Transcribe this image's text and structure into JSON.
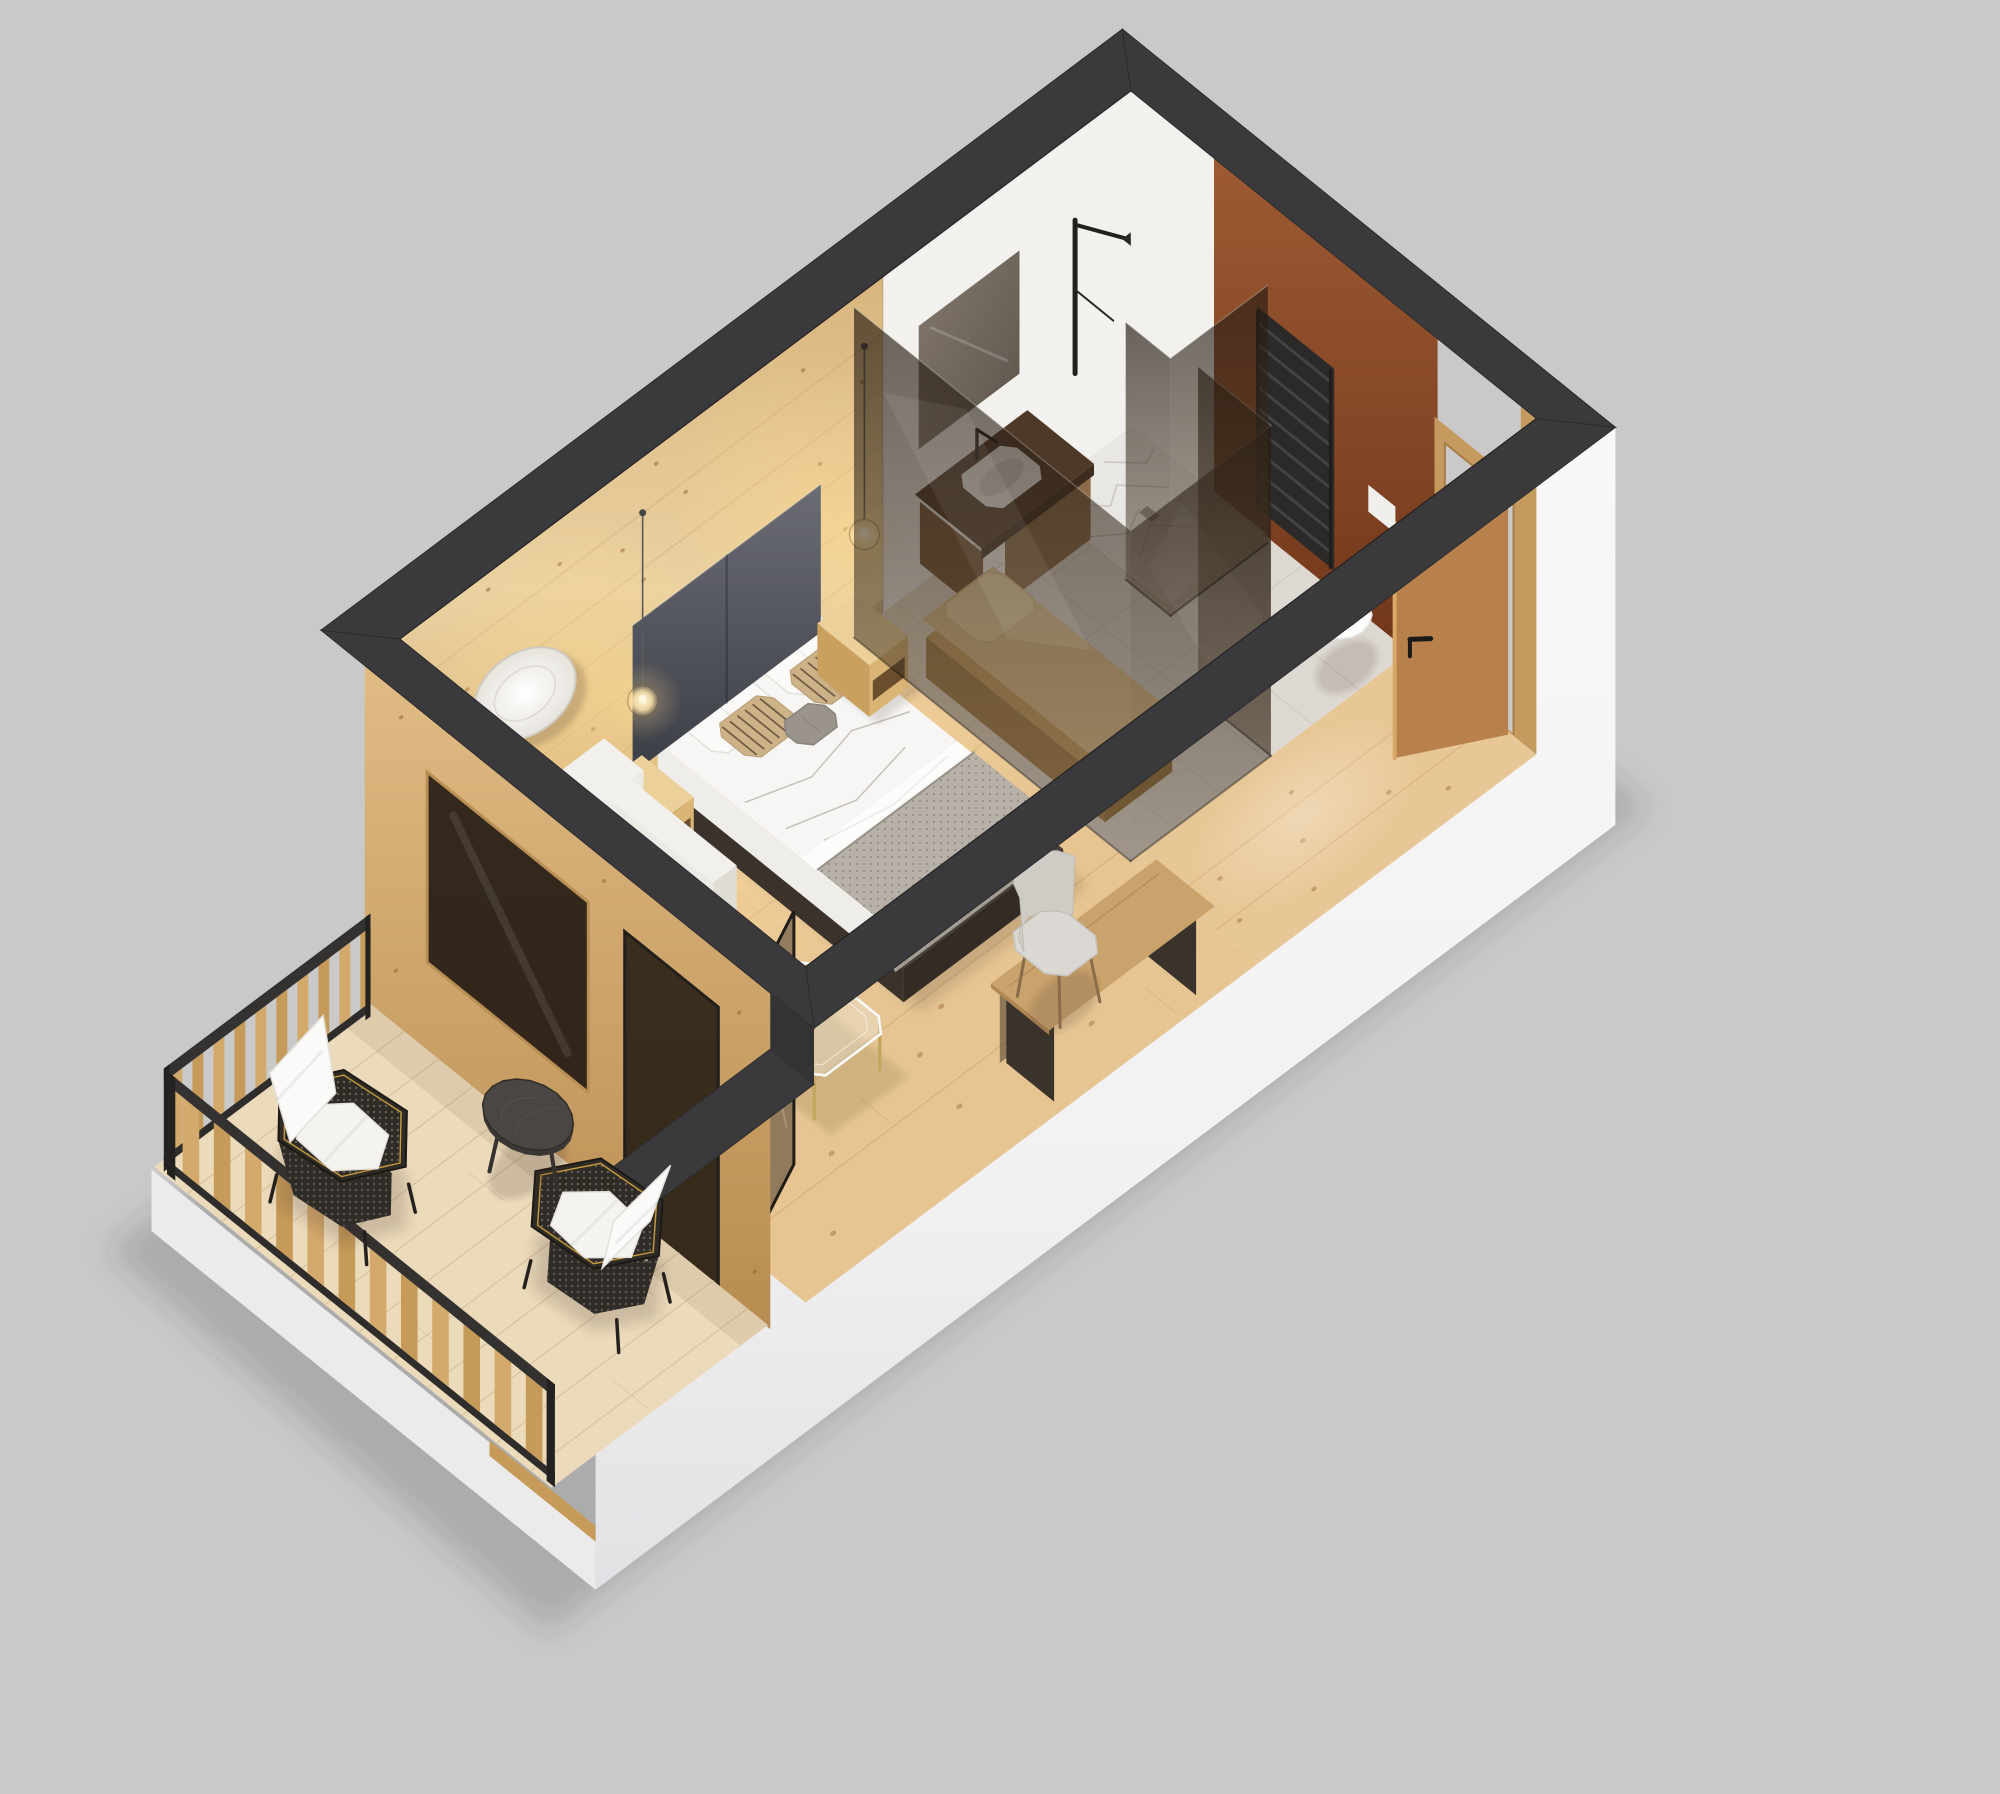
{
  "scene_title": "3D isometric floor-plan render of a hotel studio room with balcony",
  "canvas": {
    "width": 2000,
    "height": 1794,
    "background": "#c9c9c9"
  },
  "projection": {
    "origin": [
      400,
      975
    ],
    "axis_u": [
      84,
      -63
    ],
    "axis_v": [
      104,
      84
    ],
    "axis_z": [
      0,
      -112
    ],
    "angle_u_deg": -37
  },
  "room": {
    "length": 8.7,
    "width": 3.9,
    "wall_height": 3.0,
    "wall_thickness": 0.42,
    "balcony_depth": 3.0,
    "parapet_height": 2.5,
    "railing_height": 0.92,
    "bedroom_end_u": 5.38,
    "bath_corridor_v": 2.68
  },
  "palette": {
    "bg": "#c9c9c9",
    "shadow": "rgba(60,58,52,0.20)",
    "charcoal": "#3a3a3c",
    "charcoal_dark": "#2c2c2e",
    "facade_white": "#f5f5f6",
    "facade_shade": "#e6e6e9",
    "skirt_white": "#ebebec",
    "floor_bed": "#e6c592",
    "floor_plank_line": "#c9a26a",
    "floor_knot": "#a4713a",
    "floor_entry": "#e8c796",
    "tile": "#ddd8d1",
    "tile_line": "#c7c2ba",
    "white_wall": "#f3f1ed",
    "terracotta_hi": "#9d5a33",
    "terracotta_lo": "#6f3519",
    "marble": "#e9e7e3",
    "marble_vein": "#c2beb9",
    "marble_curb": "#d6d3ce",
    "glass_fill": "rgba(32,23,15,0.55)",
    "glass_hi": "rgba(255,255,255,0.07)",
    "glass_edge": "#16100a",
    "headboard_hi": "#6b6c75",
    "headboard_lo": "#3c3e46",
    "mattress": "#f7f6f4",
    "duvet_line": "rgba(185,181,174,0.9)",
    "duvet_side": "#ebe9e4",
    "blanket": "#b7b1a8",
    "blanket_side": "#a39d94",
    "blanket_dot": "#8d8780",
    "pillow_white": "#fbfaf9",
    "pillow_edge": "#e2e0db",
    "pillow_stripe_base": "#cdb287",
    "pillow_stripe_line": "#5f4f3a",
    "pillow_gray": "#9b948c",
    "platform_dark": "#332b24",
    "platform_side": "#3b332b",
    "nightstand_top": "#ecd09a",
    "nightstand_front": "#d9b474",
    "nightstand_side": "#c9a05e",
    "nightstand_slot": "#6b4e2e",
    "cord": "#5a5a5a",
    "sofa_hi": "#f2f0ec",
    "sofa_mid": "#eceae5",
    "sofa_lo": "#e0ddd7",
    "plaid_base": "#e9e7e3",
    "plaid_line": "rgba(95,93,90,0.55)",
    "cushion_tan1": "#e6c98f",
    "cushion_tan2": "#dcbf85",
    "glass_table_stroke": "#fafaf8",
    "glass_table_fill": "rgba(235,240,240,0.32)",
    "table_leg_gold": "#c2a75f",
    "desk_wood": "#caa26b",
    "desk_leg": "#3a332c",
    "chair_gray": "#dbd8d3",
    "chair_gray_lo": "#cfccc6",
    "door_leaf": "#b8804a",
    "door_leaf_edge": "#d8a868",
    "door_frame": "#c59a5f",
    "handle_dark": "#1c1a18",
    "radiator_dark": "#2b2a29",
    "radiator_bar": "#454341",
    "toilet_white": "#fdfdfc",
    "toilet_seat": "#d8d6d3",
    "vanity_counter": "#4e3929",
    "vanity_cabinet": "#8a6a48",
    "basin_white": "#f4f3f0",
    "towel_white": "#f7f6f3",
    "bath_mirror_hi": "#7b6f63",
    "bath_mirror_lo": "#4e463d",
    "bench_wood": "#c9a266",
    "bench_front": "#a5814f",
    "bench_side": "#93713f",
    "bench_cushion": "#e0c291",
    "bench_cushion_side": "#cdb07e",
    "bench_pillow": "#ecd6a8",
    "deck": "#ecdbbb",
    "deck_line": "#d9c49e",
    "rail_dark": "#2e2d2b",
    "rail_top": "#343230",
    "slat_a": "#d4a96c",
    "slat_b": "#c69a58",
    "wicker_dark": "#2f2b26",
    "wicker_edge": "#1d1a16",
    "wicker_gold": "#c79b3c",
    "cushion_white": "#f4f3f0",
    "round_table": "#4a4643",
    "round_table_edge": "#3a3734",
    "wood_wall_knot": "rgba(140,90,40,0.5)",
    "glow_line": "rgba(150,105,55,0.22)"
  },
  "furniture": {
    "bed": {
      "u": [
        2.9,
        4.8
      ],
      "v": [
        0.08,
        2.5
      ]
    },
    "headboard": {
      "u": [
        2.72,
        4.96
      ],
      "z": [
        0.3,
        1.62
      ]
    },
    "nightstand_left": {
      "u": [
        2.32,
        2.78
      ],
      "v": [
        0.08,
        0.58
      ]
    },
    "nightstand_right": {
      "u": [
        4.87,
        5.33
      ],
      "v": [
        0.08,
        0.58
      ]
    },
    "pendant_left_u": 2.48,
    "pendant_right_u": 5.12,
    "mirror": {
      "u": 1.45,
      "z": 1.72
    },
    "sofa": {
      "u": [
        0.2,
        2.28
      ],
      "v": [
        0.12,
        1.32
      ],
      "chaise_u": [
        0.2,
        1.1
      ],
      "chaise_v": 1.95
    },
    "coffee_table": {
      "u": [
        1.38,
        2.28
      ],
      "v": [
        2.02,
        2.88
      ]
    },
    "desk": {
      "u": [
        2.95,
        4.92
      ],
      "v": [
        3.3,
        3.86
      ]
    },
    "desk_chair": {
      "u": 3.89,
      "v": 3.16
    },
    "balcony_door_v": [
      2.5,
      3.4
    ],
    "divider_window_v": [
      0.6,
      2.15
    ],
    "vanity": {
      "u": [
        6.08,
        7.42
      ],
      "v": [
        0.04,
        0.68
      ]
    },
    "shower": {
      "u": [
        7.5,
        8.66
      ],
      "v": [
        0.05,
        1.32
      ]
    },
    "bench": {
      "u": [
        5.52,
        6.32
      ],
      "v": [
        0.6,
        2.32
      ]
    },
    "toilet": {
      "u": 8.2,
      "v": 2.42
    },
    "radiator": {
      "v": [
        1.28,
        2.02
      ],
      "z": [
        0.28,
        2.08
      ]
    },
    "entry_door_v": [
      2.92,
      3.78
    ],
    "balcony_chair_1": {
      "u": -2.02,
      "v": 1.08,
      "back_deg": 262
    },
    "balcony_chair_2": {
      "u": -1.12,
      "v": 2.8,
      "back_deg": 84
    },
    "balcony_table": {
      "u": -0.68,
      "v": 1.78
    }
  },
  "decor": {
    "floor_knots": [
      [
        0.5,
        1.1
      ],
      [
        0.9,
        2.3
      ],
      [
        1.3,
        3.1
      ],
      [
        1.7,
        0.7
      ],
      [
        2.1,
        1.9
      ],
      [
        2.45,
        3.4
      ],
      [
        2.8,
        0.5
      ],
      [
        3.1,
        2.7
      ],
      [
        3.5,
        1.2
      ],
      [
        3.9,
        3.5
      ],
      [
        4.3,
        0.8
      ],
      [
        4.6,
        2.2
      ],
      [
        4.9,
        3.2
      ],
      [
        5.1,
        1.6
      ],
      [
        0.7,
        3.6
      ],
      [
        1.5,
        2.0
      ],
      [
        2.6,
        2.9
      ],
      [
        4.1,
        1.7
      ],
      [
        3.3,
        0.4
      ],
      [
        4.95,
        0.35
      ]
    ],
    "entry_knots": [
      [
        5.8,
        3.2
      ],
      [
        6.3,
        3.7
      ],
      [
        6.9,
        3.0
      ],
      [
        7.5,
        3.45
      ],
      [
        8.1,
        3.15
      ],
      [
        6.6,
        3.35
      ],
      [
        7.9,
        3.7
      ],
      [
        5.6,
        3.55
      ]
    ],
    "wall_knots": [
      [
        0.4,
        0.6
      ],
      [
        0.8,
        2.1
      ],
      [
        1.2,
        1.2
      ],
      [
        1.9,
        2.6
      ],
      [
        2.3,
        0.9
      ],
      [
        2.9,
        1.9
      ],
      [
        3.4,
        2.4
      ],
      [
        3.8,
        0.7
      ],
      [
        4.3,
        1.5
      ],
      [
        4.8,
        2.7
      ],
      [
        5.3,
        1.0
      ],
      [
        0.6,
        1.7
      ],
      [
        1.6,
        0.4
      ],
      [
        2.0,
        1.45
      ],
      [
        3.05,
        2.85
      ],
      [
        4.55,
        0.45
      ],
      [
        5.5,
        2.2
      ],
      [
        5.0,
        1.75
      ],
      [
        1.05,
        2.85
      ],
      [
        2.65,
        2.3
      ]
    ],
    "divider_knots": [
      [
        0.3,
        0.5
      ],
      [
        0.35,
        2.8
      ],
      [
        2.3,
        2.8
      ],
      [
        3.0,
        0.6
      ],
      [
        3.6,
        2.6
      ],
      [
        3.75,
        0.4
      ]
    ],
    "floor_plank_vs": [
      0.62,
      1.27,
      1.92,
      2.57,
      3.22
    ],
    "deck_plank_step": 0.33,
    "marble_veins": [
      [
        [
          7.6,
          0.2
        ],
        [
          7.9,
          0.45
        ],
        [
          8.1,
          0.35
        ],
        [
          8.4,
          0.6
        ]
      ],
      [
        [
          7.7,
          0.9
        ],
        [
          8.0,
          0.75
        ],
        [
          8.3,
          1.0
        ],
        [
          8.55,
          0.9
        ]
      ],
      [
        [
          7.55,
          0.55
        ],
        [
          7.8,
          0.7
        ],
        [
          8.05,
          0.6
        ]
      ],
      [
        [
          8.2,
          0.15
        ],
        [
          8.45,
          0.35
        ],
        [
          8.6,
          0.3
        ]
      ]
    ],
    "duvet_folds": [
      [
        [
          3.0,
          0.9
        ],
        [
          3.6,
          1.05
        ],
        [
          4.2,
          0.95
        ],
        [
          4.7,
          1.1
        ]
      ],
      [
        [
          3.05,
          1.25
        ],
        [
          3.7,
          1.4
        ],
        [
          4.4,
          1.3
        ]
      ],
      [
        [
          3.2,
          1.5
        ],
        [
          3.9,
          1.6
        ],
        [
          4.6,
          1.55
        ]
      ]
    ]
  }
}
